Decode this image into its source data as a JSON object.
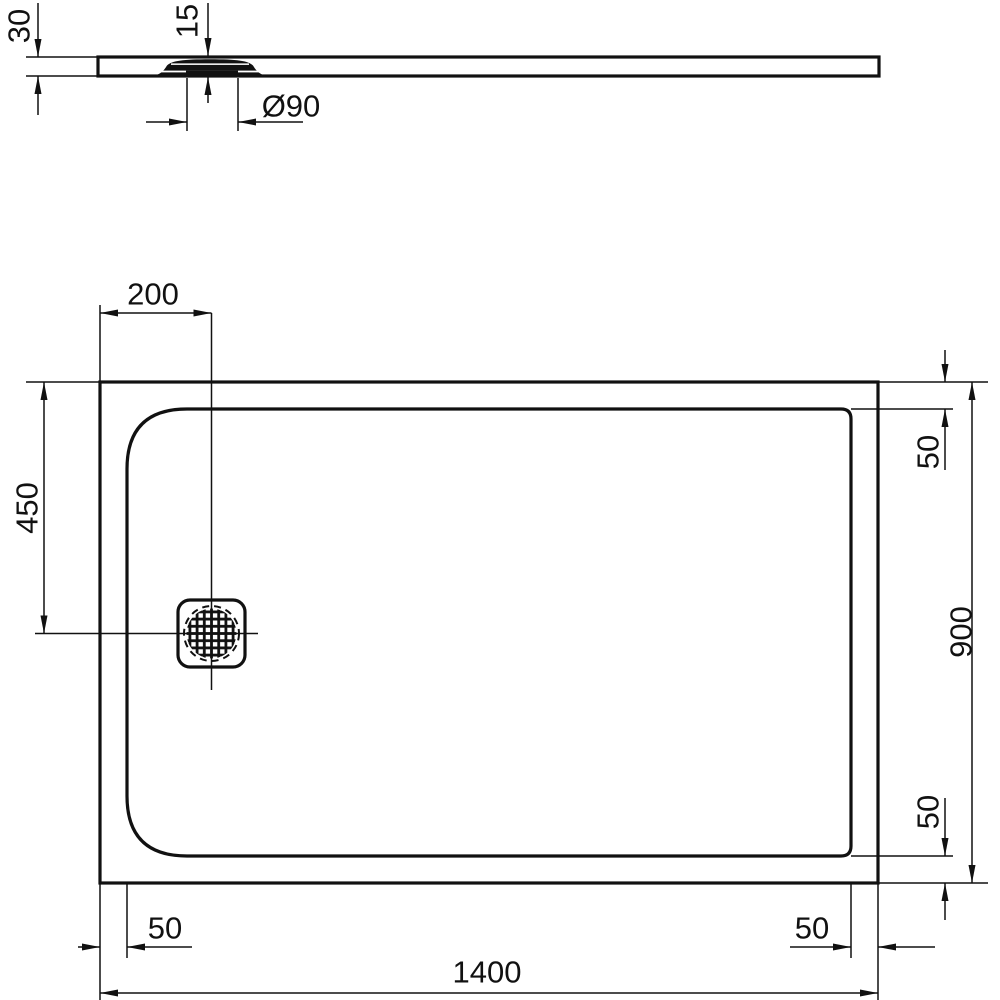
{
  "drawing": {
    "subject": "shower-tray technical dimension drawing, section view and plan view",
    "background_color": "#ffffff",
    "line_color": "#111111",
    "units": "mm"
  },
  "labels": {
    "tray_thickness": "30",
    "waste_cover_height": "15",
    "waste_diameter": "Ø90",
    "drain_offset_from_left": "200",
    "drain_offset_from_top": "450",
    "rim_inset_top_right": "50",
    "tray_width": "900",
    "rim_inset_bottom_right_vertical": "50",
    "rim_inset_bottom_left": "50",
    "rim_inset_bottom_right": "50",
    "tray_length": "1400"
  }
}
